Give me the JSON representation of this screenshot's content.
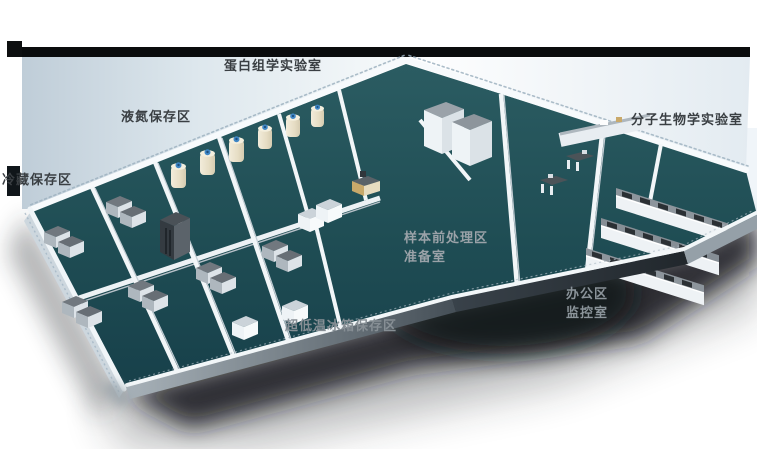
{
  "labels": {
    "proteomics_lab": "蛋白组学实验室",
    "liquid_nitrogen_area": "液氮保存区",
    "cold_storage_area": "冷藏保存区",
    "molecular_biology_lab": "分子生物学实验室",
    "sample_pretreatment_area": "样本前处理区",
    "preparation_room": "准备室",
    "office_area": "办公区",
    "monitoring_room": "监控室",
    "ult_freezer_area": "超低温冰箱保存区"
  },
  "palette": {
    "background": "#ffffff",
    "roof_band_black": "#0a0c0d",
    "back_wall_face_blue": "#bfcdd8",
    "wall_white": "#f2f6f8",
    "wall_shade": "#c3cdd4",
    "floor_teal_dark": "#17404a",
    "floor_teal": "#2b5c62",
    "freezer_gray_top": "#71787f",
    "freezer_gray_front": "#aeb7be",
    "cabinet_white": "#eef3f6",
    "tank_cream": "#eae3cf",
    "tank_cap_blue": "#3f87c6",
    "bench_top_gray": "#8d959c",
    "bench_window_dark": "#2b3034",
    "shadow_dark": "#14181c",
    "label_dark": "#3a3f43",
    "label_light": "#9aa2a8"
  }
}
